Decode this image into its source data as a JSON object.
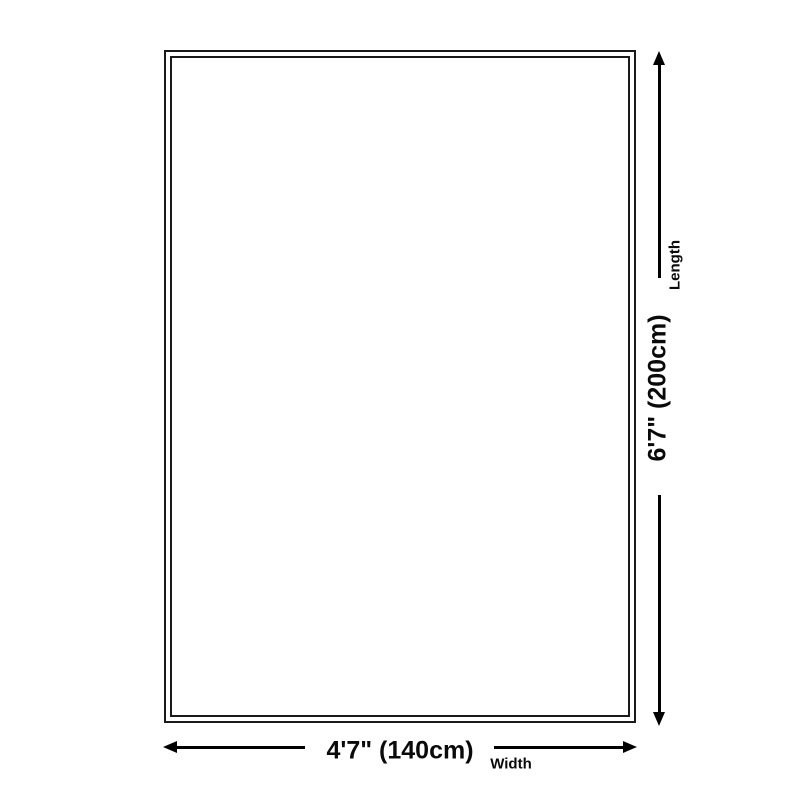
{
  "diagram": {
    "type": "size-dimension-diagram",
    "item": "rug outline",
    "length": {
      "value": "6'7\" (200cm)",
      "label": "Length"
    },
    "width": {
      "value": "4'7\" (140cm)",
      "label": "Width"
    },
    "colors": {
      "background": "#ffffff",
      "line": "#000000",
      "text": "#0a0a0a",
      "rug_border": "#1a1a1a"
    }
  }
}
